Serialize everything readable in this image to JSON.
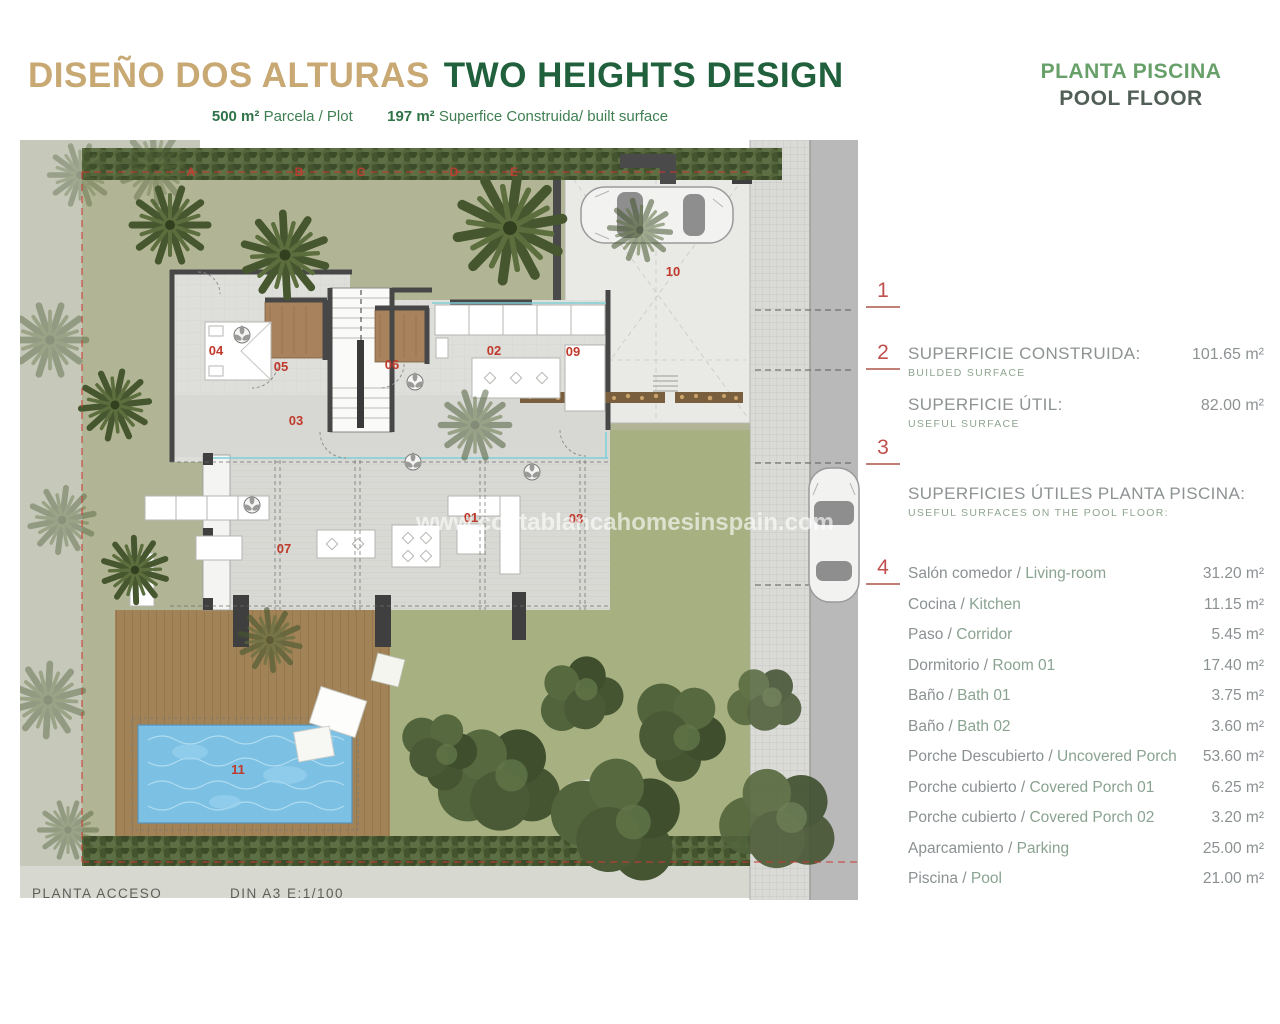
{
  "header": {
    "title_es": "DISEÑO DOS ALTURAS",
    "title_en": "TWO HEIGHTS DESIGN",
    "plot_value": "500 m²",
    "plot_label": "Parcela / Plot",
    "built_value": "197 m²",
    "built_label": "Superfice Construida/ built surface"
  },
  "floor_label": {
    "es": "PLANTA PISCINA",
    "en": "POOL FLOOR"
  },
  "markers": [
    "1",
    "2",
    "3",
    "4"
  ],
  "summary": [
    {
      "label": "SUPERFICIE CONSTRUIDA:",
      "sub": "BUILDED SURFACE",
      "value": "101.65 m²"
    },
    {
      "label": "SUPERFICIE ÚTIL:",
      "sub": "USEFUL SURFACE",
      "value": "82.00 m²"
    }
  ],
  "section": {
    "title": "SUPERFICIES ÚTILES PLANTA PISCINA:",
    "subtitle": "USEFUL SURFACES ON THE POOL FLOOR:"
  },
  "surfaces": [
    {
      "es": "Salón comedor",
      "en": "Living-room",
      "value": "31.20 m²"
    },
    {
      "es": "Cocina",
      "en": "Kitchen",
      "value": "11.15 m²"
    },
    {
      "es": "Paso",
      "en": "Corridor",
      "value": "5.45 m²"
    },
    {
      "es": "Dormitorio",
      "en": "Room 01",
      "value": "17.40 m²"
    },
    {
      "es": "Baño",
      "en": "Bath 01",
      "value": "3.75 m²"
    },
    {
      "es": "Baño",
      "en": "Bath 02",
      "value": "3.60 m²"
    },
    {
      "es": "Porche Descubierto",
      "en": "Uncovered Porch",
      "value": "53.60 m²"
    },
    {
      "es": "Porche cubierto",
      "en": "Covered Porch 01",
      "value": "6.25 m²"
    },
    {
      "es": "Porche cubierto",
      "en": "Covered Porch 02",
      "value": "3.20 m²"
    },
    {
      "es": "Aparcamiento",
      "en": "Parking",
      "value": "25.00 m²"
    },
    {
      "es": "Piscina",
      "en": "Pool",
      "value": "21.00 m²"
    }
  ],
  "footer": {
    "plan_name": "PLANTA ACCESO",
    "scale": "DIN A3  E:1/100"
  },
  "plan": {
    "watermark": "www.costablancahomesinspain.com",
    "room_labels": [
      {
        "text": "01",
        "x": 451,
        "y": 382
      },
      {
        "text": "02",
        "x": 474,
        "y": 215
      },
      {
        "text": "03",
        "x": 276,
        "y": 285
      },
      {
        "text": "04",
        "x": 196,
        "y": 215
      },
      {
        "text": "05",
        "x": 261,
        "y": 231
      },
      {
        "text": "06",
        "x": 372,
        "y": 229
      },
      {
        "text": "07",
        "x": 264,
        "y": 413
      },
      {
        "text": "08",
        "x": 556,
        "y": 383
      },
      {
        "text": "09",
        "x": 553,
        "y": 216
      },
      {
        "text": "10",
        "x": 653,
        "y": 136
      },
      {
        "text": "11",
        "x": 218,
        "y": 634
      }
    ],
    "boundary_letters": [
      {
        "text": "A",
        "x": 171,
        "y": 36
      },
      {
        "text": "B",
        "x": 279,
        "y": 36
      },
      {
        "text": "C",
        "x": 341,
        "y": 36
      },
      {
        "text": "D",
        "x": 434,
        "y": 36
      },
      {
        "text": "E",
        "x": 494,
        "y": 36
      }
    ],
    "colors": {
      "accent_red": "#c0392b",
      "garden": "#b2b595",
      "lawn": "#a7b080",
      "deck": "#a28257",
      "pool": "#7cc0e4",
      "wall": "#474747",
      "road": "#b9b9b9",
      "sidewalk": "#dcdcd9"
    }
  }
}
